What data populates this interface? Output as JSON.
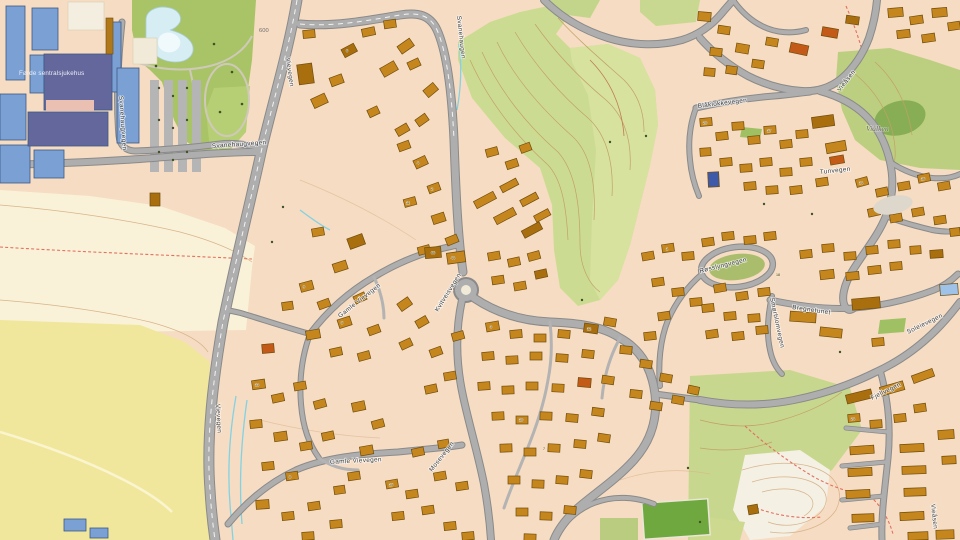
{
  "labels": {
    "hospital": "Førde sentralsjukehus",
    "contour_600": "600",
    "vievegen_a": "Vievegen",
    "vievegen_b": "Vievegen",
    "svanehaugvegen_a": "Svanehaugvegen",
    "svanehaugvegen_b": "Svanehaugvegen",
    "svanehaugen": "Svanehaugen",
    "gamle_vievegen_a": "Gamle Vievegen",
    "gamle_vievegen_b": "Gamle Vievegen",
    "kvitveisvegen": "Kvitveisvegen",
    "blaklokkevegen": "Blåklokkevegen",
    "viaasen_a": "Vieåsen",
    "viaasen_b": "Vieåsen",
    "vialken": "Viålken",
    "rosslyngvegen": "Røsslyngvegen",
    "smorblomvegen": "Smørblomvegen",
    "bregnetunet": "Bregnetunet",
    "soleievegen": "Soleievegen",
    "fjellvegen": "Fjellvegen",
    "tunvegen": "Tunvegen",
    "mosevegen": "Mosevegen"
  },
  "house_numbers": [
    "6",
    "44",
    "66",
    "4",
    "2",
    "11",
    "9",
    "5",
    "13",
    "8",
    "15",
    "3",
    "10",
    "7",
    "12",
    "1",
    "20",
    "17",
    "14",
    "16",
    "24",
    "18"
  ],
  "colors": {
    "terrain": "#f6dcc2",
    "field_cream": "#f9f2d8",
    "field_yellow": "#f0e79c",
    "park_green": "#a9c466",
    "hill_green": "#ccdb92",
    "right_green": "#bccf80",
    "forest_green": "#87ae55",
    "water": "#d6edf4",
    "building": "#c5871d",
    "building_dark": "#a96e0e",
    "building_red": "#c35a17",
    "building_navy": "#3f5aa8",
    "building_lightblue": "#9fc2e8",
    "hospital_blue": "#7ba0d4",
    "hospital_slate": "#63679b",
    "sports_green": "#6fa83e"
  }
}
